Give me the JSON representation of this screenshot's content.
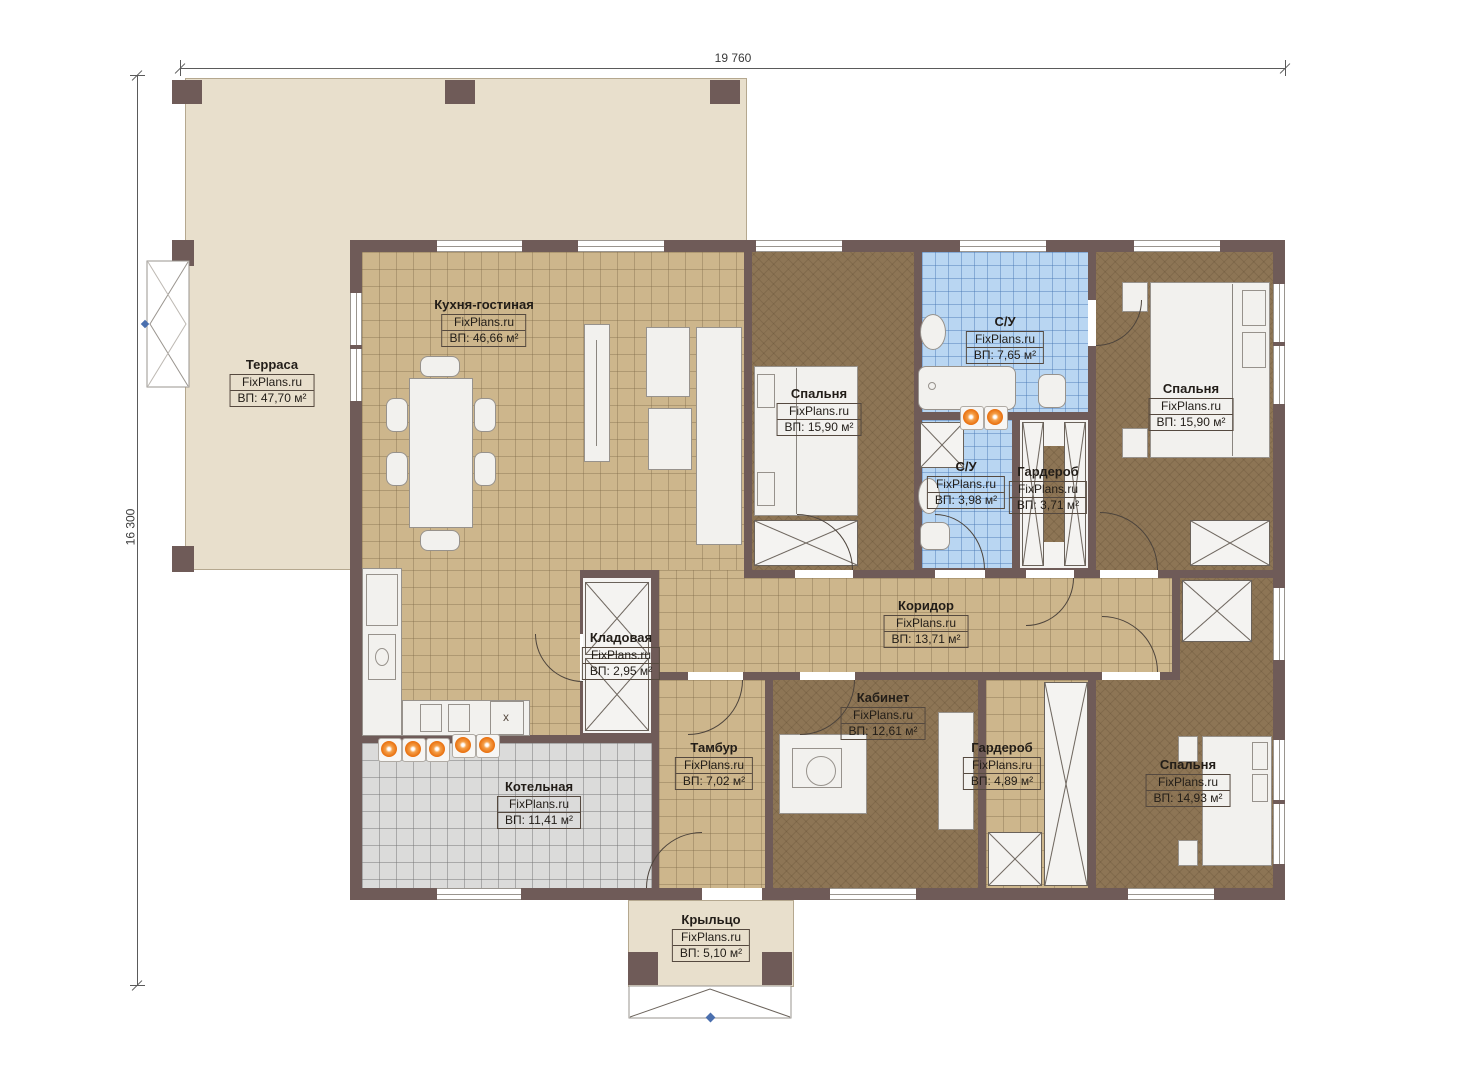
{
  "brand": "FixPlans.ru",
  "dimensions": {
    "width_label": "19 760",
    "height_label": "16 300"
  },
  "symbols": {
    "stove_sink_mark": "x"
  },
  "colors": {
    "wall": "#6f5b58",
    "terrace_fill": "#e8dfcc",
    "kitchen_tile": "#cdb68c",
    "bathroom_tile": "#b9d6f2",
    "boiler_tile": "#dbdbda",
    "bedroom_floor": "#8d7555",
    "accent_orange": "#ea7413",
    "marker_blue": "#4a6fae"
  },
  "rooms": [
    {
      "id": "terrace",
      "name": "Терраса",
      "brand": "FixPlans.ru",
      "area": "ВП: 47,70 м²"
    },
    {
      "id": "kitchen",
      "name": "Кухня-гостиная",
      "brand": "FixPlans.ru",
      "area": "ВП: 46,66 м²"
    },
    {
      "id": "bedroom1",
      "name": "Спальня",
      "brand": "FixPlans.ru",
      "area": "ВП: 15,90 м²"
    },
    {
      "id": "su1",
      "name": "С/У",
      "brand": "FixPlans.ru",
      "area": "ВП: 7,65 м²"
    },
    {
      "id": "bedroom2",
      "name": "Спальня",
      "brand": "FixPlans.ru",
      "area": "ВП: 15,90 м²"
    },
    {
      "id": "su2",
      "name": "С/У",
      "brand": "FixPlans.ru",
      "area": "ВП: 3,98 м²"
    },
    {
      "id": "garderob1",
      "name": "Гардероб",
      "brand": "FixPlans.ru",
      "area": "ВП: 3,71 м²"
    },
    {
      "id": "corridor",
      "name": "Коридор",
      "brand": "FixPlans.ru",
      "area": "ВП: 13,71 м²"
    },
    {
      "id": "kladovaya",
      "name": "Кладовая",
      "brand": "FixPlans.ru",
      "area": "ВП: 2,95 м²"
    },
    {
      "id": "kabinet",
      "name": "Кабинет",
      "brand": "FixPlans.ru",
      "area": "ВП: 12,61 м²"
    },
    {
      "id": "tambur",
      "name": "Тамбур",
      "brand": "FixPlans.ru",
      "area": "ВП: 7,02 м²"
    },
    {
      "id": "garderob2",
      "name": "Гардероб",
      "brand": "FixPlans.ru",
      "area": "ВП: 4,89 м²"
    },
    {
      "id": "bedroom3",
      "name": "Спальня",
      "brand": "FixPlans.ru",
      "area": "ВП: 14,93 м²"
    },
    {
      "id": "kotelnaya",
      "name": "Котельная",
      "brand": "FixPlans.ru",
      "area": "ВП: 11,41 м²"
    },
    {
      "id": "porch",
      "name": "Крыльцо",
      "brand": "FixPlans.ru",
      "area": "ВП: 5,10 м²"
    }
  ]
}
